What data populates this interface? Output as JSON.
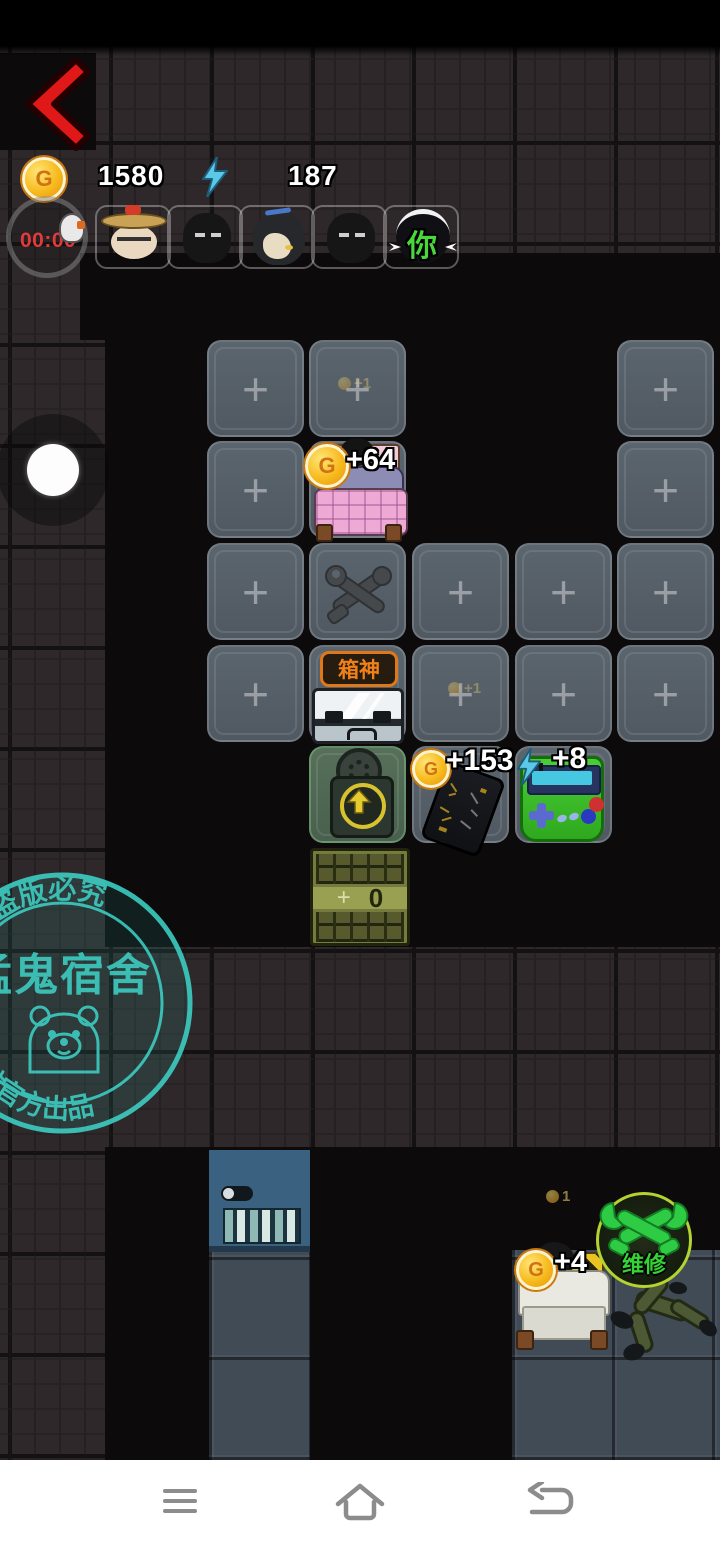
{
  "topbar": {
    "coins": "1580",
    "energy": "187"
  },
  "timer": {
    "value": "00:00"
  },
  "roster": {
    "you_label": "你"
  },
  "board": {
    "plus": "+",
    "cols": [
      207,
      309,
      412,
      515,
      617
    ],
    "rows": [
      340,
      441,
      543,
      645,
      746
    ],
    "cells": [
      {
        "c": 0,
        "r": 0,
        "t": "plus"
      },
      {
        "c": 1,
        "r": 0,
        "t": "plus"
      },
      {
        "c": 4,
        "r": 0,
        "t": "plus"
      },
      {
        "c": 0,
        "r": 1,
        "t": "plus"
      },
      {
        "c": 1,
        "r": 1,
        "t": "plain"
      },
      {
        "c": 4,
        "r": 1,
        "t": "plus"
      },
      {
        "c": 0,
        "r": 2,
        "t": "plus"
      },
      {
        "c": 1,
        "r": 2,
        "t": "plain"
      },
      {
        "c": 2,
        "r": 2,
        "t": "plus"
      },
      {
        "c": 3,
        "r": 2,
        "t": "plus"
      },
      {
        "c": 4,
        "r": 2,
        "t": "plus"
      },
      {
        "c": 0,
        "r": 3,
        "t": "plus"
      },
      {
        "c": 1,
        "r": 3,
        "t": "plain"
      },
      {
        "c": 2,
        "r": 3,
        "t": "plus"
      },
      {
        "c": 3,
        "r": 3,
        "t": "plus"
      },
      {
        "c": 4,
        "r": 3,
        "t": "plus"
      },
      {
        "c": 1,
        "r": 4,
        "t": "green"
      },
      {
        "c": 2,
        "r": 4,
        "t": "plain"
      },
      {
        "c": 3,
        "r": 4,
        "t": "plain"
      }
    ]
  },
  "items": {
    "bed1_gain": "+64",
    "ghost_above_bed": "+1",
    "box_label": "箱神",
    "ghost_mid": "+1",
    "card_gain": "+153",
    "console_gain": "+8",
    "door_plus": "+",
    "door_count": "0"
  },
  "bottom": {
    "bed2_gain": "+4",
    "repair_label": "维修",
    "ghost_small": "1"
  },
  "watermark": {
    "arc_top": "耻  盗版必究",
    "title": "猛鬼宿舍",
    "arc_bottom": "工坊官方出品"
  },
  "colors": {
    "coin_gold": "#f7ba1e",
    "energy_blue": "#5bc8e8",
    "timer_red": "#e03a3a",
    "label_orange": "#f08018",
    "repair_green": "#35d435",
    "watermark_teal": "#3ed8cc",
    "back_red": "#e01818"
  }
}
